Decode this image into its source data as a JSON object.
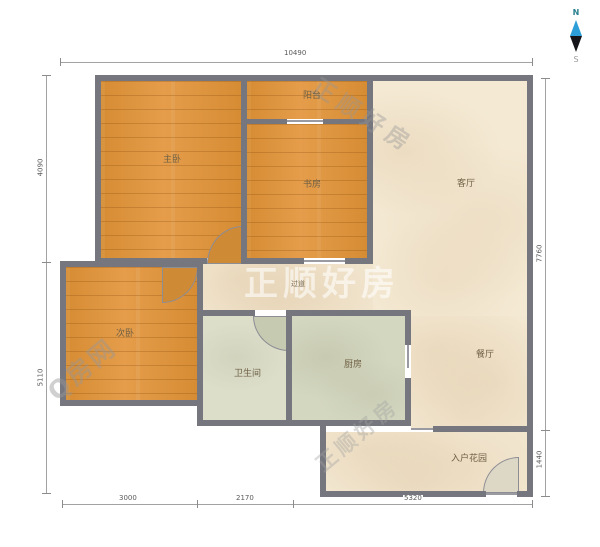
{
  "title": "户型图",
  "rooms": {
    "master_bedroom": {
      "label": "主卧"
    },
    "balcony": {
      "label": "阳台"
    },
    "study": {
      "label": "书房"
    },
    "living_room": {
      "label": "客厅"
    },
    "second_bedroom": {
      "label": "次卧"
    },
    "bathroom": {
      "label": "卫生间"
    },
    "kitchen": {
      "label": "厨房"
    },
    "dining_room": {
      "label": "餐厅"
    },
    "entry_garden": {
      "label": "入户花园"
    },
    "hallway": {
      "label": "过道"
    }
  },
  "dimensions": {
    "top": {
      "value": "10490"
    },
    "left_upper": {
      "value": "4090"
    },
    "left_lower": {
      "value": "5110"
    },
    "right_upper": {
      "value": "7760"
    },
    "right_lower": {
      "value": "1440"
    },
    "bottom_left": {
      "value": "3000"
    },
    "bottom_middle": {
      "value": "2170"
    },
    "bottom_right": {
      "value": "5320"
    }
  },
  "compass": {
    "north_label": "N",
    "south_label": "S",
    "needle_top_color": "#2d9fd8",
    "needle_bottom_color": "#15151a"
  },
  "watermarks": {
    "center": "正顺好房",
    "top_diagonal": "正顺好房",
    "bottom_left_diagonal": "Q房网",
    "bottom_center_diagonal": "正顺好房"
  },
  "colors": {
    "wall": "#76767e",
    "wood_floor": "#dd9340",
    "living_floor": "#f4e9d3",
    "kitchen_floor": "#d4d7c0",
    "bathroom_floor": "#dcdeca"
  }
}
